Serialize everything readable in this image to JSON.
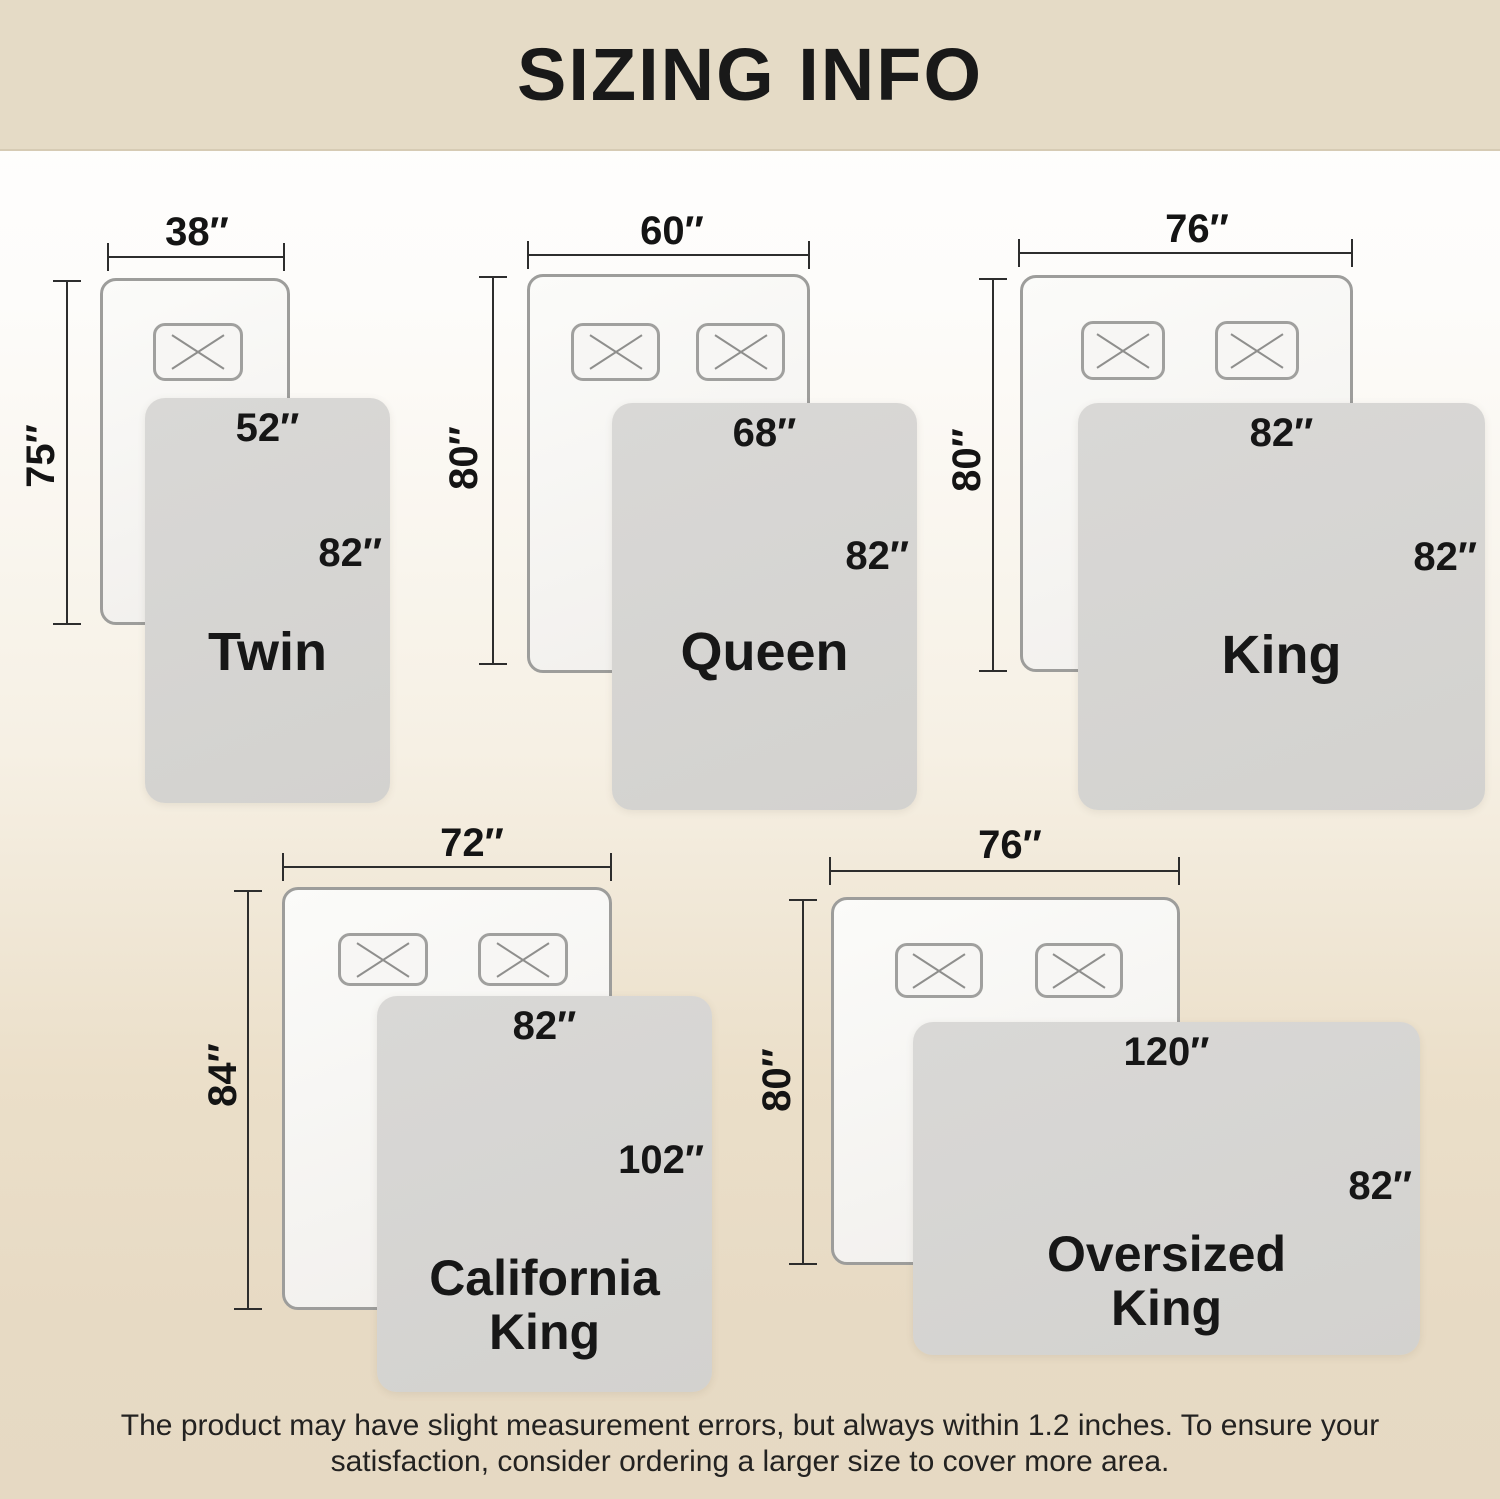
{
  "header": {
    "title": "SIZING INFO"
  },
  "sizes": [
    {
      "name": "Twin",
      "name2": "",
      "bed_width": "38″",
      "bed_length": "75″",
      "blanket_width": "52″",
      "blanket_length": "82″"
    },
    {
      "name": "Queen",
      "name2": "",
      "bed_width": "60″",
      "bed_length": "80″",
      "blanket_width": "68″",
      "blanket_length": "82″"
    },
    {
      "name": "King",
      "name2": "",
      "bed_width": "76″",
      "bed_length": "80″",
      "blanket_width": "82″",
      "blanket_length": "82″"
    },
    {
      "name": "California",
      "name2": "King",
      "bed_width": "72″",
      "bed_length": "84″",
      "blanket_width": "82″",
      "blanket_length": "102″"
    },
    {
      "name": "Oversized",
      "name2": "King",
      "bed_width": "76″",
      "bed_length": "80″",
      "blanket_width": "120″",
      "blanket_length": "82″"
    }
  ],
  "footer": {
    "note_line1": "The product may have slight measurement errors, but always within 1.2 inches. To ensure your",
    "note_line2": "satisfaction, consider ordering a larger size to cover more area."
  },
  "colors": {
    "banner_bg": "#e5dbc6",
    "page_bottom_beige": "#e6d9c3",
    "blanket_gray": "#d6d5d3",
    "bed_outline_gray": "#9d9d9b",
    "text_black": "#1b1b1b"
  }
}
